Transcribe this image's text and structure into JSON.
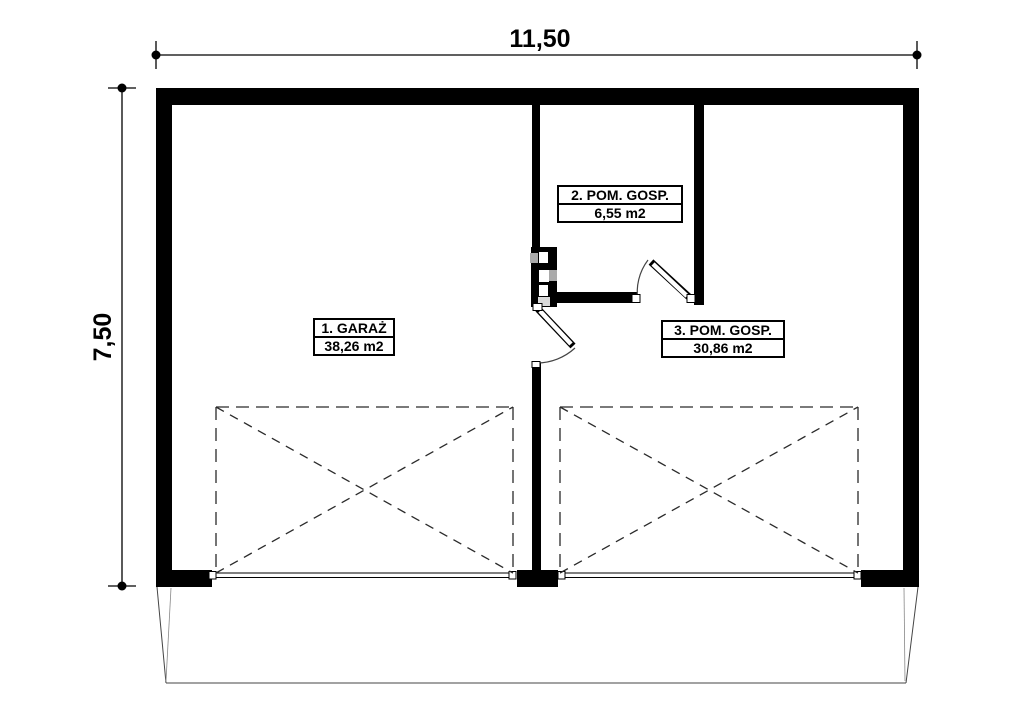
{
  "plan": {
    "type": "garage-floor-plan",
    "dimensions": {
      "width_label": "11,50",
      "height_label": "7,50"
    },
    "rooms": [
      {
        "name": "1. GARAŻ",
        "area": "38,26 m2"
      },
      {
        "name": "2. POM. GOSP.",
        "area": "6,55 m2"
      },
      {
        "name": "3. POM. GOSP.",
        "area": "30,86 m2"
      }
    ],
    "colors": {
      "wall": "#000000",
      "background": "#ffffff",
      "flue_gray": "#aaaaaa",
      "flue_light_gray": "#d9d9d9",
      "thin_line": "#444444"
    }
  }
}
